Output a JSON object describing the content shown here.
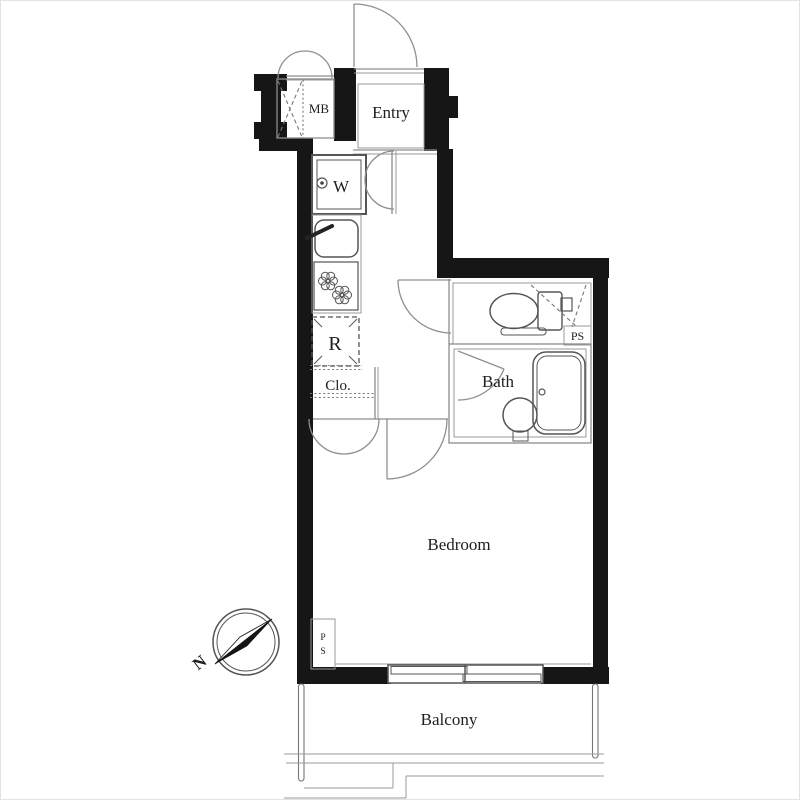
{
  "document": {
    "kind": "apartment floor plan"
  },
  "colors": {
    "wall": "#161616",
    "thin_line": "#8d8d8d",
    "fixture_line": "#555555",
    "text": "#1e1e1e",
    "background": "#ffffff"
  },
  "rooms": {
    "meter_box": {
      "label": "MB"
    },
    "entry": {
      "label": "Entry"
    },
    "washer_space": {
      "label": "W"
    },
    "refrigerator_space": {
      "label": "R"
    },
    "closet": {
      "label": "Clo."
    },
    "bath": {
      "label": "Bath"
    },
    "bedroom": {
      "label": "Bedroom"
    },
    "balcony": {
      "label": "Balcony"
    }
  },
  "annotations": {
    "pipe_space_right": {
      "label": "PS"
    },
    "pipe_space_bottom": {
      "line1": "P",
      "line2": "S"
    },
    "compass_north": {
      "label": "N"
    }
  }
}
